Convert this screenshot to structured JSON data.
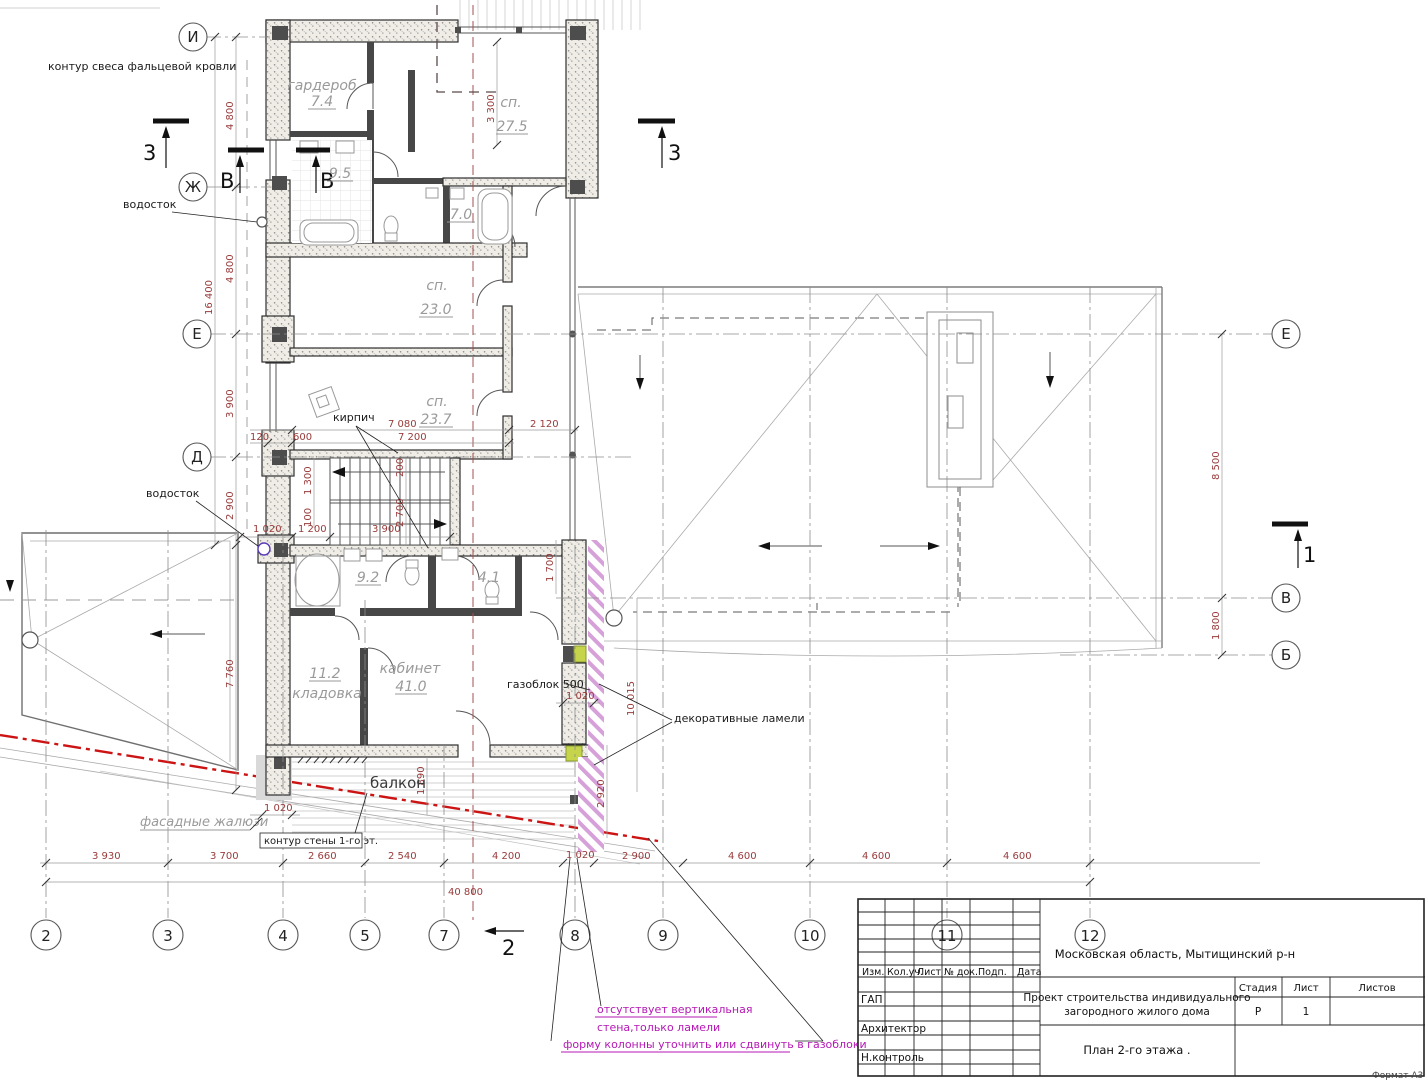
{
  "drawing": {
    "annotations": {
      "roof_overhang": "контур свеса фальцевой кровли",
      "drain_top": "водосток",
      "drain_mid": "водосток",
      "brick": "кирпич",
      "facade_louvers": "фасадные жалюзи",
      "wall_contour": "контур стены 1-го эт.",
      "gas_block": "газоблок 500",
      "lamellae": "декоративные ламели",
      "balcony": "балкон",
      "note1_l1": "отсутствует вертикальная",
      "note1_l2": "стена,только ламели",
      "note2": "форму колонны уточнить или сдвинуть в газоблоки",
      "format": "Формат А3"
    },
    "rooms": {
      "wardrobe_name": "гардероб",
      "wardrobe_area": "7.4",
      "bedroom1_name": "сп.",
      "bedroom1_area": "27.5",
      "bath1_area": "9.5",
      "bath2_area": "7.0",
      "bedroom2_name": "сп.",
      "bedroom2_area": "23.0",
      "bedroom3_name": "сп.",
      "bedroom3_area": "23.7",
      "bath3_area": "9.2",
      "wc_area": "4.1",
      "storage_name": "кладовка",
      "storage_area": "11.2",
      "cabinet_name": "кабинет",
      "cabinet_area": "41.0"
    },
    "axes": {
      "i": "И",
      "zh": "Ж",
      "e_l": "Е",
      "d": "Д",
      "e_r": "Е",
      "v_r": "В",
      "b_r": "Б"
    },
    "grid": {
      "g2": "2",
      "g3": "3",
      "g4": "4",
      "g5": "5",
      "g7": "7",
      "g8": "8",
      "g9": "9",
      "g10": "10",
      "g11": "11",
      "g12": "12"
    },
    "sections": {
      "s3a": "3",
      "s3b": "3",
      "va": "В",
      "vb": "В",
      "s1": "1",
      "s2": "2"
    },
    "dims": {
      "d4800a": "4 800",
      "d16400": "16 400",
      "d4800b": "4 800",
      "d3900": "3 900",
      "d2900": "2 900",
      "d7760": "7 760",
      "d1020_wall": "1 020",
      "d1300": "1 300",
      "d100": "100",
      "d1020_st": "1 020",
      "d1200": "1 200",
      "d3900_st": "3 900",
      "d200": "200",
      "d2700": "2 700",
      "d120": "120",
      "d600": "600",
      "d7080": "7 080",
      "d7200": "7 200",
      "d2120": "2 120",
      "d3300": "3 300",
      "d1700": "1 700",
      "d8500": "8 500",
      "d1800": "1 800",
      "d1890": "1 890",
      "d1020_gas": "1 020",
      "d10015": "10 015",
      "d2920": "2 920",
      "d1020_piera": "1 020",
      "d1020_bot": "1 020",
      "b3930": "3 930",
      "b3700": "3 700",
      "b2660": "2 660",
      "b2540": "2 540",
      "b4200": "4 200",
      "b1020": "1 020",
      "b2900": "2 900",
      "b4600a": "4 600",
      "b4600b": "4 600",
      "b4600c": "4 600",
      "btotal": "40 800"
    },
    "title_block": {
      "region": "Московская область, Мытищинский р-н",
      "project_l1": "Проект строительства индивидуального",
      "project_l2": "загородного жилого дома",
      "plan": "План 2-го этажа .",
      "stage_h": "Стадия",
      "sheet_h": "Лист",
      "sheets_h": "Листов",
      "stage_v": "Р",
      "sheet_v": "1",
      "col_izm": "Изм.",
      "col_kol": "Кол.уч.",
      "col_list": "Лист",
      "col_doc": "№ док.",
      "col_podp": "Подп.",
      "col_data": "Дата",
      "row_gap": "ГАП",
      "row_arch": "Архитектор",
      "row_control": "Н.контроль"
    }
  }
}
